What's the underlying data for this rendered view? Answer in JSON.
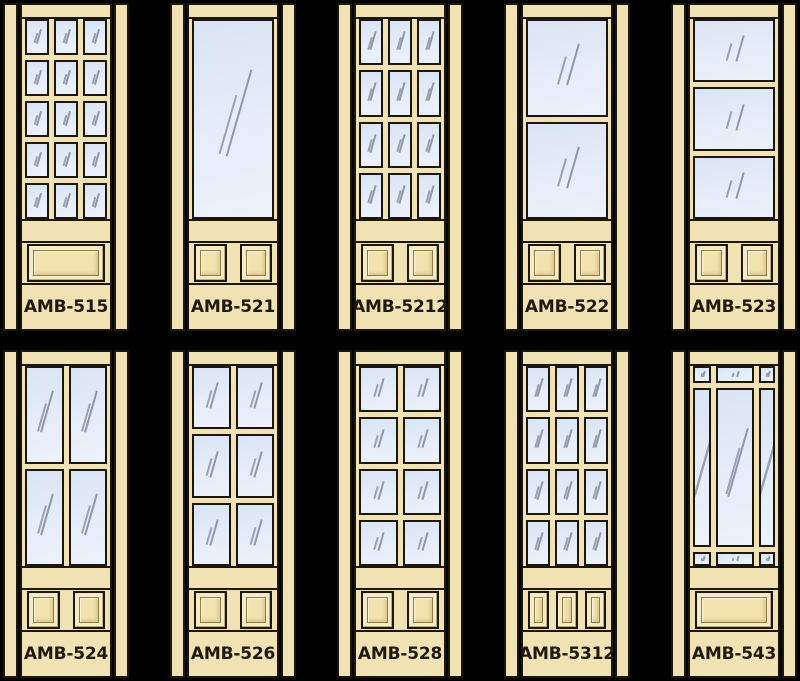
{
  "page": {
    "background": "#000000",
    "description": "Catalog grid of ten interior door styles, AMB series, shown as illustrations with glass lites on top and raised wood panels below"
  },
  "palette": {
    "wood": "#f1e2b3",
    "outline": "#1c160d",
    "glass_top": "#d9e4f4",
    "glass_bottom": "#ecf2fb",
    "glass_shine": "#8e99ac",
    "panel_ring": "#f6ebc5",
    "panel_field": "#f2e2ad",
    "label_text": "#1f1910"
  },
  "rows": [
    {
      "doors": [
        {
          "label": "AMB-515",
          "lites": {
            "layout": "grid",
            "cols": 3,
            "rows": 5,
            "count": 15
          },
          "bottom_panels": {
            "layout": "single-wide",
            "count": 1
          }
        },
        {
          "label": "AMB-521",
          "lites": {
            "layout": "grid",
            "cols": 1,
            "rows": 1,
            "count": 1
          },
          "bottom_panels": {
            "layout": "two-square",
            "count": 2
          }
        },
        {
          "label": "AMB-5212",
          "lites": {
            "layout": "grid",
            "cols": 3,
            "rows": 4,
            "count": 12
          },
          "bottom_panels": {
            "layout": "two-square",
            "count": 2
          }
        },
        {
          "label": "AMB-522",
          "lites": {
            "layout": "grid",
            "cols": 1,
            "rows": 2,
            "count": 2
          },
          "bottom_panels": {
            "layout": "two-square",
            "count": 2
          }
        },
        {
          "label": "AMB-523",
          "lites": {
            "layout": "grid",
            "cols": 1,
            "rows": 3,
            "count": 3
          },
          "bottom_panels": {
            "layout": "two-square",
            "count": 2
          }
        }
      ]
    },
    {
      "doors": [
        {
          "label": "AMB-524",
          "lites": {
            "layout": "grid",
            "cols": 2,
            "rows": 2,
            "count": 4
          },
          "bottom_panels": {
            "layout": "two-square",
            "count": 2
          }
        },
        {
          "label": "AMB-526",
          "lites": {
            "layout": "grid",
            "cols": 2,
            "rows": 3,
            "count": 6
          },
          "bottom_panels": {
            "layout": "two-square",
            "count": 2
          }
        },
        {
          "label": "AMB-528",
          "lites": {
            "layout": "grid",
            "cols": 2,
            "rows": 4,
            "count": 8
          },
          "bottom_panels": {
            "layout": "two-square",
            "count": 2
          }
        },
        {
          "label": "AMB-5312",
          "lites": {
            "layout": "grid",
            "cols": 3,
            "rows": 4,
            "count": 12
          },
          "bottom_panels": {
            "layout": "three-vertical",
            "count": 3
          }
        },
        {
          "label": "AMB-543",
          "lites": {
            "layout": "prairie",
            "cols": 3,
            "rows": 3,
            "count": 9
          },
          "bottom_panels": {
            "layout": "single-wide",
            "count": 1
          }
        }
      ]
    }
  ]
}
